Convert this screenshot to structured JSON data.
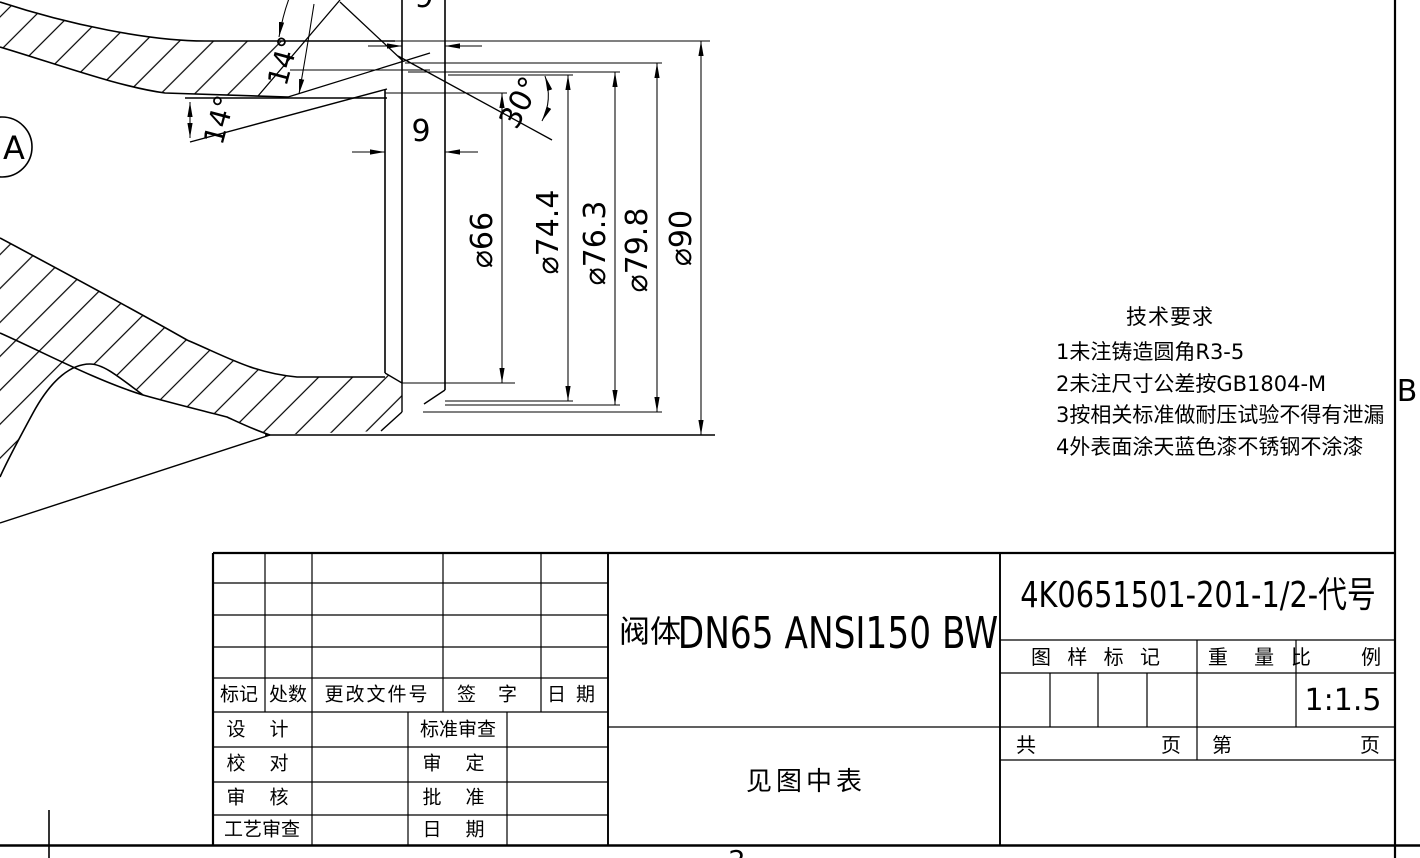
{
  "sheet": {
    "paper_color": "#ffffff",
    "ink_color": "#000000",
    "zone_label_left": "A",
    "zone_label_right": "B",
    "zone_number_bottom": "2"
  },
  "dimensions": {
    "width_top": "9",
    "width_mid": "9",
    "angle_upper": "14°",
    "angle_lower": "14°",
    "angle_bevel": "30°",
    "dia_1": "⌀66",
    "dia_2": "⌀74.4",
    "dia_3": "⌀76.3",
    "dia_4": "⌀79.8",
    "dia_5": "⌀90"
  },
  "tech_requirements": {
    "title": "技术要求",
    "items": [
      "1未注铸造圆角R3-5",
      "2未注尺寸公差按GB1804-M",
      "3按相关标准做耐压试验不得有泄漏",
      "4外表面涂天蓝色漆不锈钢不涂漆"
    ]
  },
  "title_block": {
    "part_prefix": "阀体",
    "part_name": "DN65 ANSI150 BW",
    "drawing_number": "4K0651501-201-1/2-代号",
    "material_note": "见图中表",
    "revision_headers": [
      "标记",
      "处数",
      "更改文件号",
      "签 字",
      "日 期"
    ],
    "sign_rows": [
      [
        "设 计",
        "标准审查"
      ],
      [
        "校 对",
        "审 定"
      ],
      [
        "审 核",
        "批 准"
      ],
      [
        "工艺审查",
        "日 期"
      ]
    ],
    "stamp_header": "图 样 标 记",
    "weight_header": "重 量",
    "scale_header": "比 例",
    "scale_value": "1:1.5",
    "total_prefix": "共",
    "total_suffix": "页",
    "page_prefix": "第",
    "page_suffix": "页"
  }
}
